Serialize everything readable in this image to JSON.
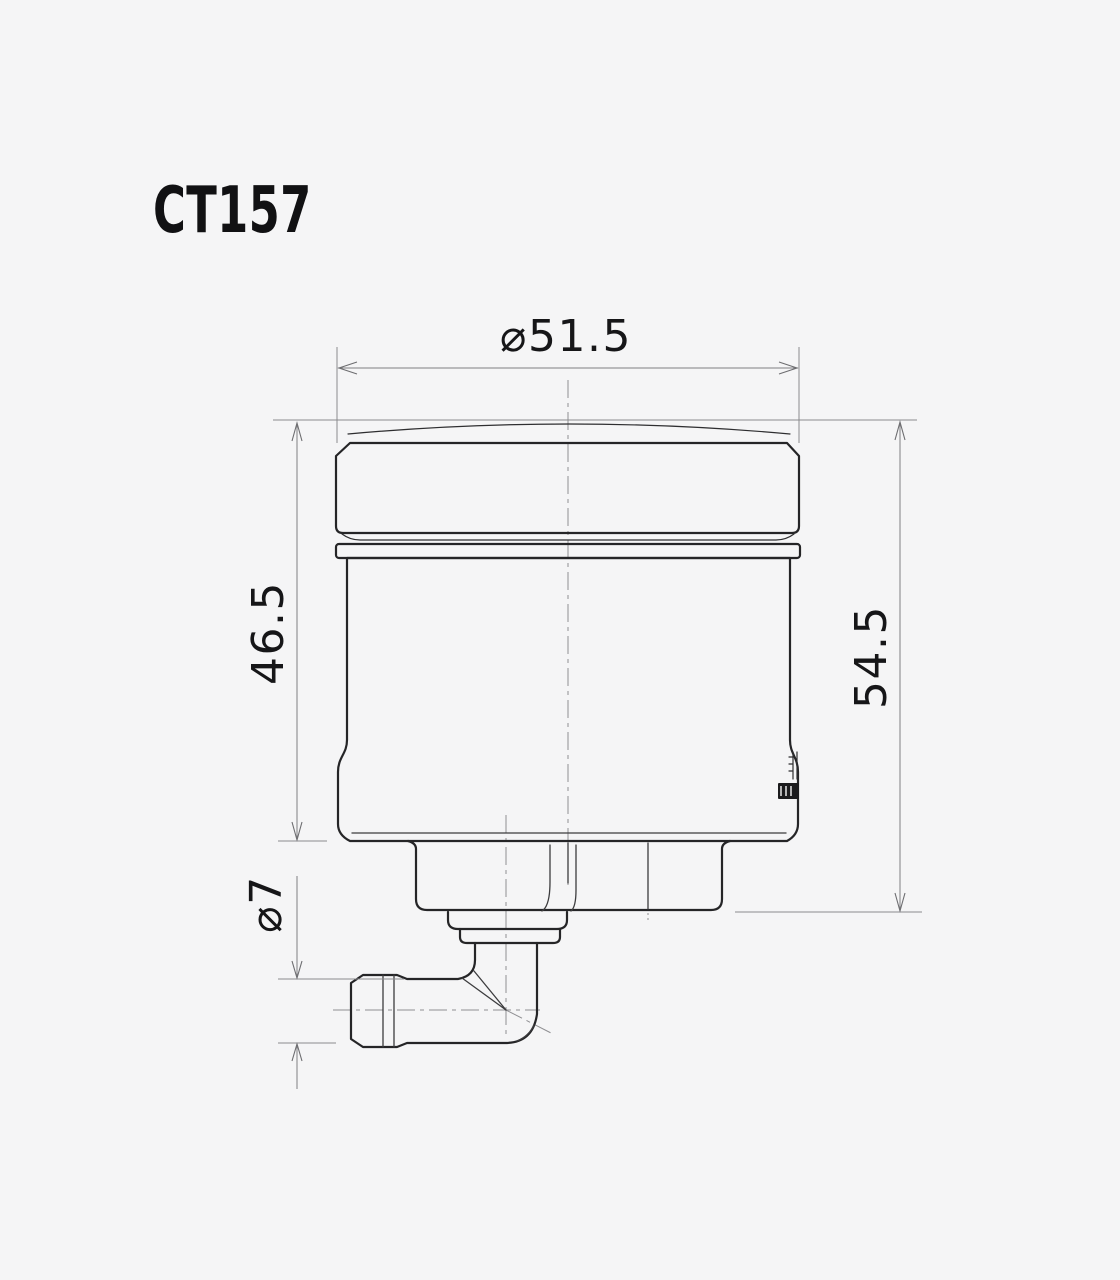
{
  "title": "CT157",
  "drawing": {
    "part_code": "CT157",
    "kind": "technical-drawing",
    "view": "front-elevation",
    "dimensions": [
      {
        "id": "cap-diameter",
        "label": "⌀51.5",
        "value": 51.5,
        "type": "diameter",
        "orientation": "horizontal",
        "measures": "reservoir cap outer diameter"
      },
      {
        "id": "body-height",
        "label": "46.5",
        "value": 46.5,
        "type": "linear",
        "orientation": "vertical",
        "measures": "cap top to body bottom"
      },
      {
        "id": "overall-height",
        "label": "54.5",
        "value": 54.5,
        "type": "linear",
        "orientation": "vertical",
        "measures": "cap top to collar bottom"
      },
      {
        "id": "outlet-diameter",
        "label": "⌀7",
        "value": 7,
        "type": "diameter",
        "orientation": "vertical",
        "measures": "hose barb outlet diameter"
      }
    ],
    "parts": [
      "cap-dome",
      "reservoir-cap",
      "seal-ring-band",
      "reservoir-body",
      "mounting-collar",
      "outlet-step-upper",
      "outlet-step-lower",
      "outlet-elbow",
      "hose-barb"
    ],
    "icons": {
      "brand_mark": "engraved-logo-plaque"
    },
    "colors": {
      "background": "#f5f5f6",
      "part_line": "#252527",
      "dimension_line": "#7f7f82",
      "centerline": "#8f8f92",
      "text": "#161618"
    }
  }
}
